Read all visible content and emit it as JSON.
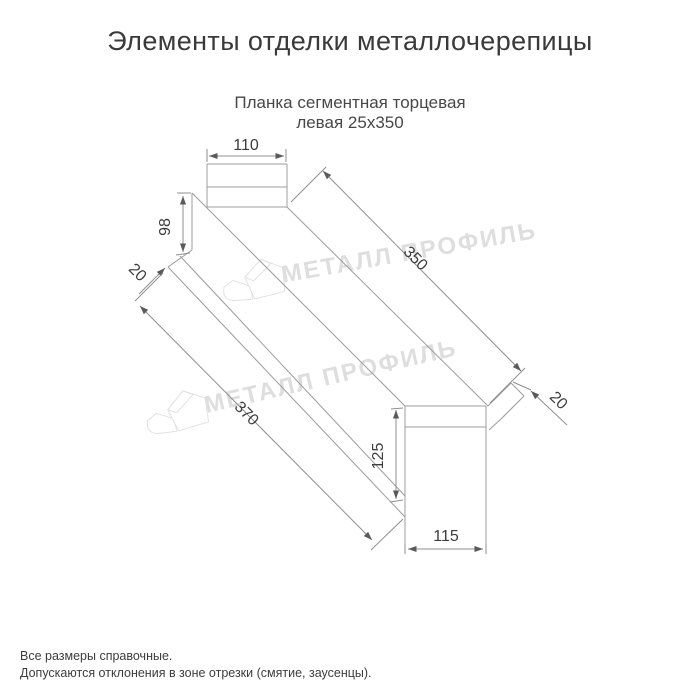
{
  "title": "Элементы отделки металлочерепицы",
  "subtitle": {
    "line1": "Планка сегментная торцевая",
    "line2": "левая 25х350"
  },
  "drawing": {
    "type": "isometric technical drawing of left segmental end strip",
    "dimensions": {
      "top_flange_width": "110",
      "left_end_height": "98",
      "left_hem": "20",
      "length_top": "350",
      "length_bottom": "370",
      "right_hem": "20",
      "right_end_height": "125",
      "right_end_width": "115"
    },
    "watermark_brand": "МЕТАЛЛ ПРОФИЛЬ",
    "colors": {
      "line": "#9c9c9c",
      "dim_text": "#3c3c3c",
      "watermark": "#dedede"
    }
  },
  "footer": {
    "note1": "Все размеры справочные.",
    "note2": "Допускаются отклонения в зоне отрезки (смятие, заусенцы)."
  }
}
